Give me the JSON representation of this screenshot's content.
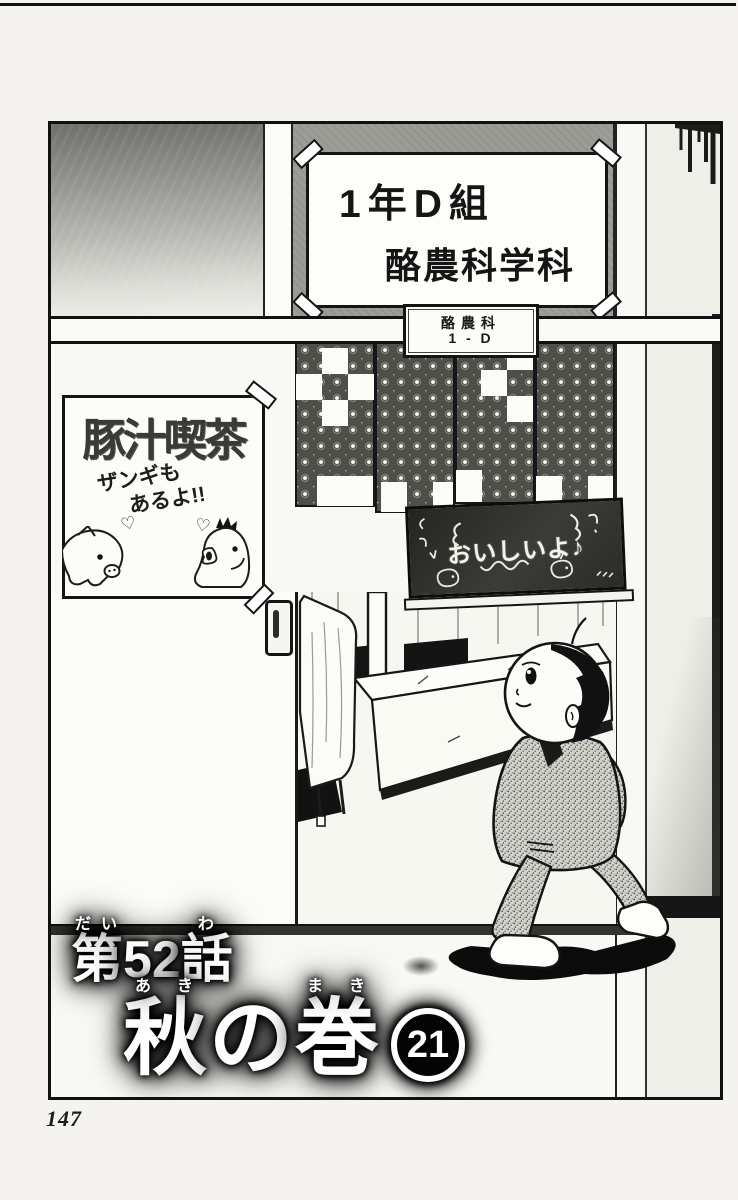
{
  "page": {
    "number": "147"
  },
  "colors": {
    "ink": "#141414",
    "paper": "#f4f3ef",
    "wall_gray": "#9d9d98",
    "noren_dark": "#4f4f4a",
    "chalkboard_green_black": "#2f2f2c",
    "suit_gray": "#d4d4cf"
  },
  "class_sign": {
    "line1": "1年D組",
    "line2": "酪農科学科"
  },
  "door_plate": {
    "line1": "酪農科",
    "line2": "1 - D"
  },
  "cafe_sign": {
    "title": "豚汁喫茶",
    "note_line1": "ザンギも",
    "note_line2": "あるよ!!",
    "heart": "♡"
  },
  "chalkboard": {
    "message": "おいしいよ♪"
  },
  "chapter_title": {
    "parts": [
      {
        "base": "第",
        "ruby": "だい"
      },
      {
        "base": "52",
        "ruby": ""
      },
      {
        "base": "話",
        "ruby": "わ"
      }
    ]
  },
  "volume_title": {
    "parts": [
      {
        "base": "秋",
        "ruby": "あき"
      },
      {
        "base": "の",
        "ruby": ""
      },
      {
        "base": "巻",
        "ruby": "まき"
      }
    ],
    "number": "21"
  }
}
